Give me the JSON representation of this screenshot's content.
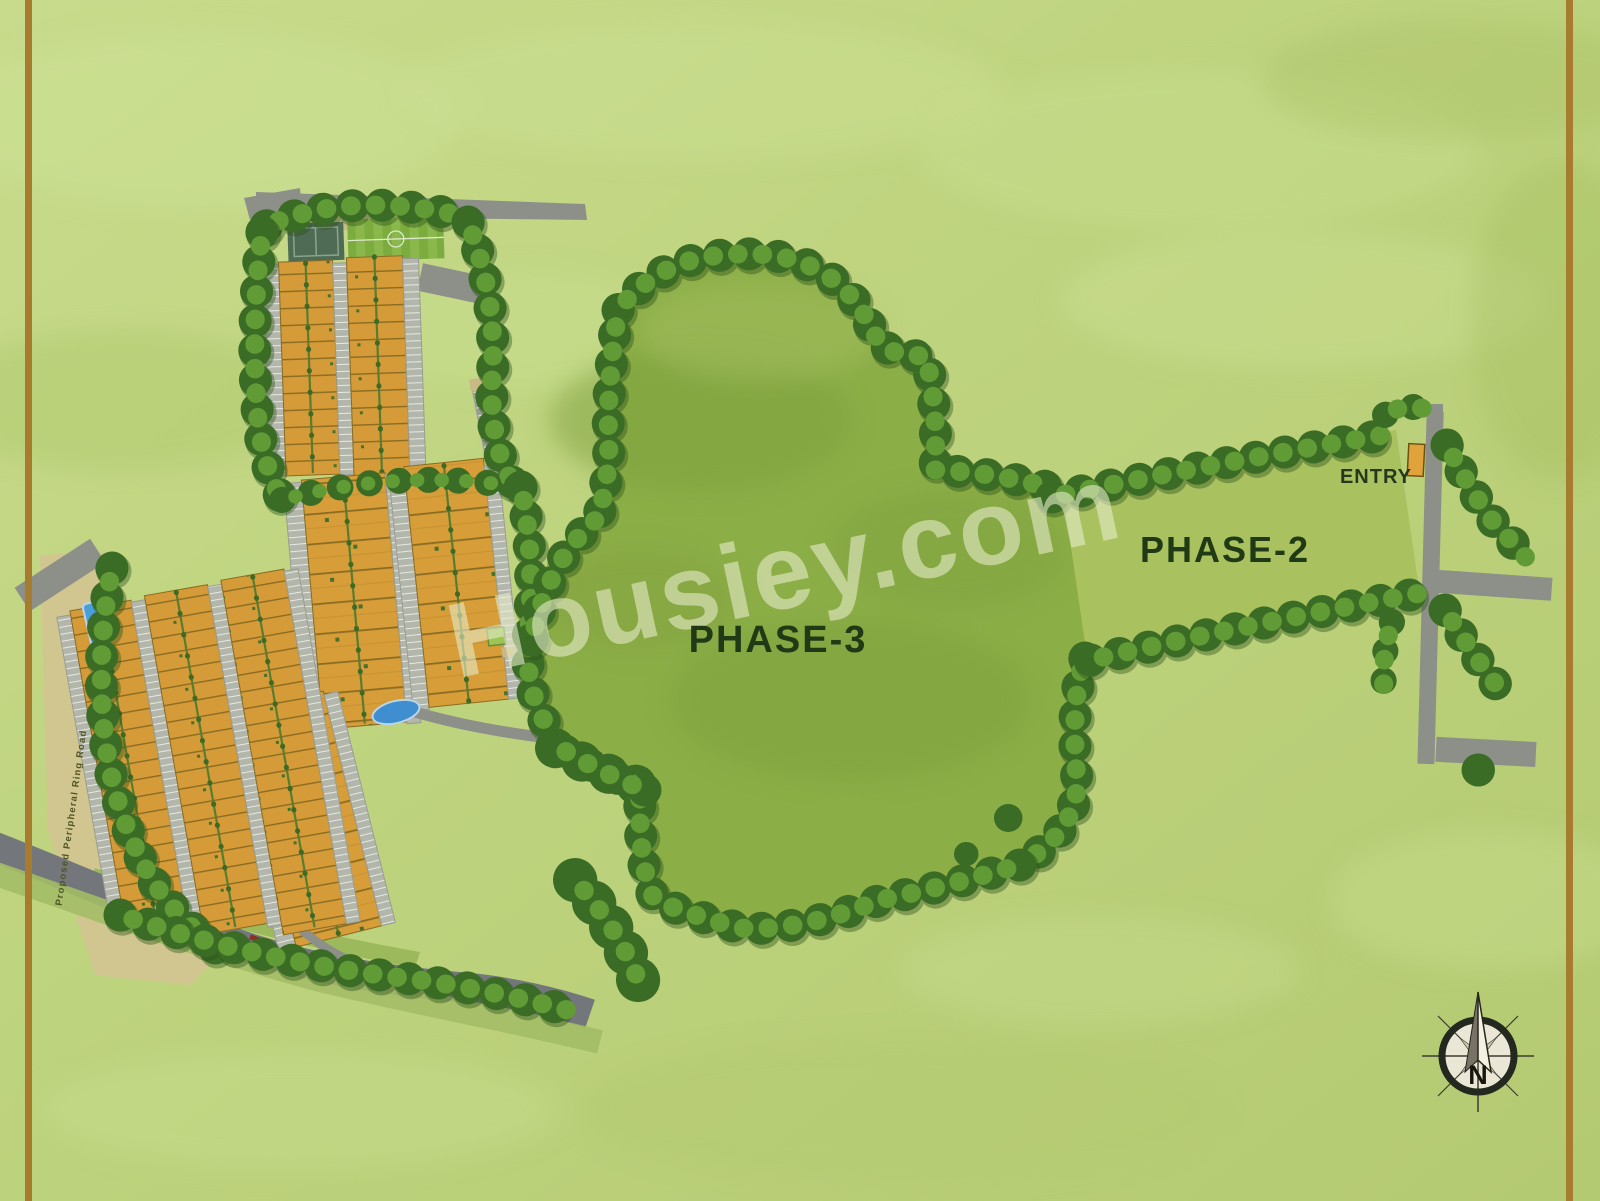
{
  "plan": {
    "watermark": "Housiey.com",
    "areas": {
      "phase3": "PHASE-3",
      "phase2": "PHASE-2"
    },
    "entry_label": "ENTRY",
    "road_label": "Proposed Peripheral Ring Road",
    "compass": {
      "north": "N"
    }
  },
  "colors": {
    "grass_background": "#bdd27c",
    "phase3_area": "#8cae47",
    "phase2_area": "#a9c25f",
    "plot_orange": "#d69d39",
    "road_gray": "#8d9088",
    "main_road_gray": "#73767a",
    "tree_dark": "#3b6c25",
    "tree_light": "#619b36",
    "frame_line_brown": "#a87c2e",
    "pool_blue": "#3e8ed0",
    "tan_strip": "#cfc08d",
    "watermark_cream": "#e7ecca",
    "label_dark_green": "#203a16"
  }
}
